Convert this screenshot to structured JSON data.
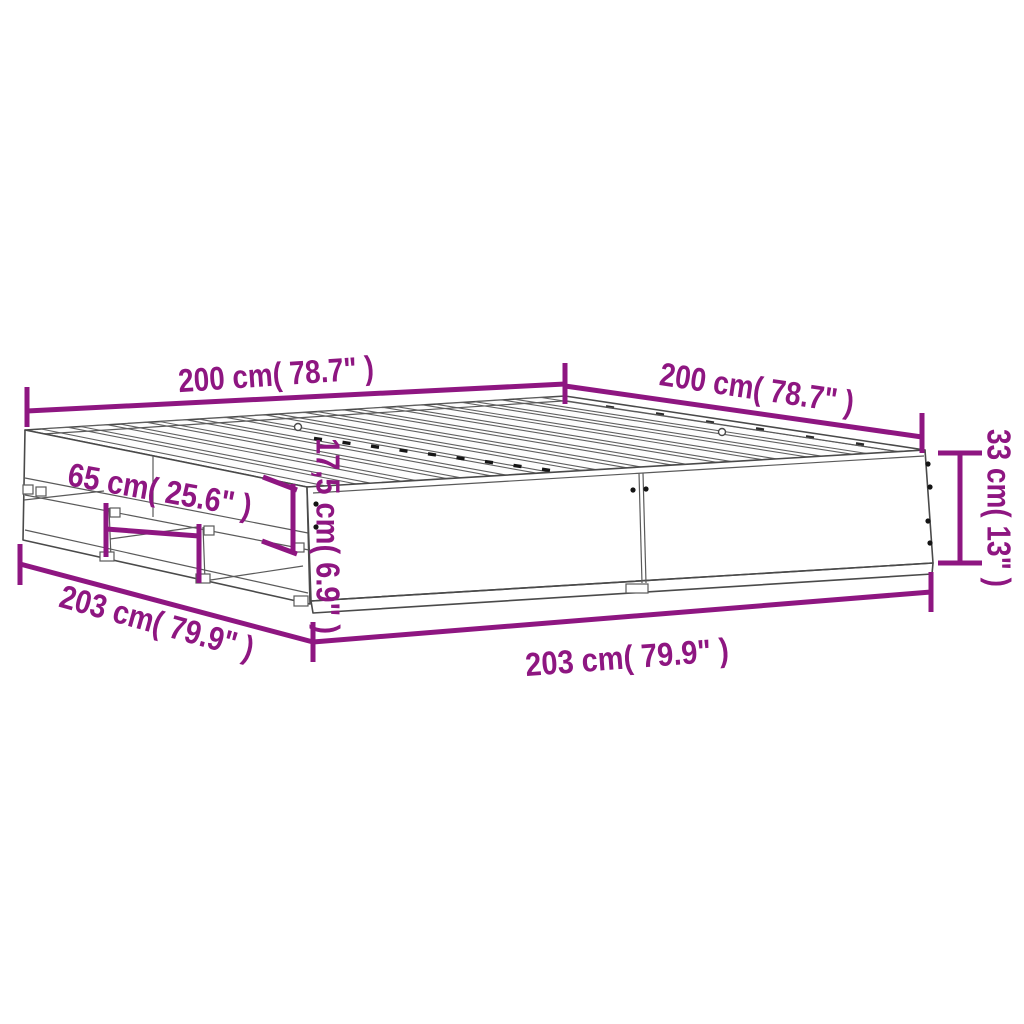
{
  "diagram": {
    "subject": "bed-frame-with-drawers-dimension-diagram",
    "accent_color": "#8E1681",
    "outline_color": "#4a4a4a",
    "background_color": "#ffffff",
    "dims": {
      "top_left_length": "200 cm( 78.7\" )",
      "top_right_width": "200 cm( 78.7\" )",
      "right_height": "33 cm( 13\" )",
      "rail_height": "17,5 cm( 6.9\" )",
      "drawer_width": "65 cm( 25.6\" )",
      "left_side_length": "203 cm( 79.9\" )",
      "bottom_front_length": "203 cm( 79.9\" )"
    }
  }
}
